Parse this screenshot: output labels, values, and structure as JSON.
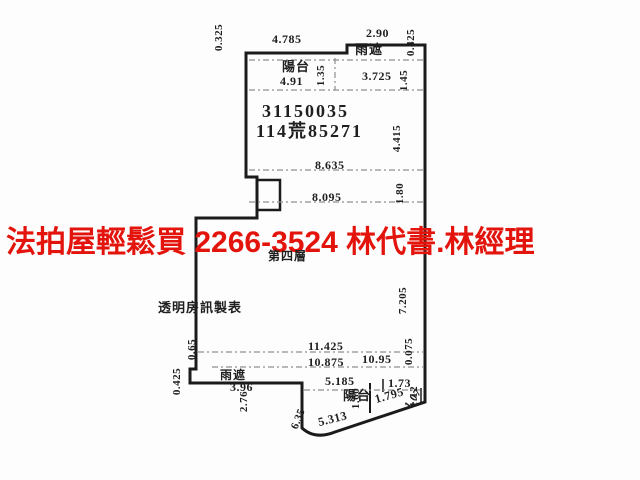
{
  "colors": {
    "wall": "#1b1b1b",
    "dash": "#8f8f8f",
    "text": "#1f1f1f",
    "ad_red": "#e3140c",
    "background": "#fdfdfd"
  },
  "overlay": {
    "ad_text": "法拍屋輕鬆買  2266-3524  林代書.林經理"
  },
  "plan": {
    "parcel_number": "31150035",
    "area_number": "114荒85271",
    "floor_label": "第四層",
    "maker_label": "透明房訊製表",
    "balcony_top_label": "陽台",
    "canopy_top_label": "雨遮",
    "balcony_bottom_label": "陽台",
    "canopy_bottom_label": "雨遮",
    "dims": {
      "top_left_side": "0.325",
      "top_width": "4.785",
      "canopy_top_width": "2.90",
      "top_right_side": "0.425",
      "balcony_top_width": "4.91",
      "balcony_top_depth": "1.35",
      "canopy_top_inner_width": "3.725",
      "canopy_top_depth": "1.45",
      "upper_room_width": "8.635",
      "right_upper_side": "4.415",
      "mid_room_width": "8.095",
      "right_mid_side": "1.80",
      "right_lower_side": "7.205",
      "bottom_total_width": "11.425",
      "bottom_inner_width": "10.875",
      "bottom_inner_width_2": "10.95",
      "right_bottom_small": "0.075",
      "left_lower_small": "0.65",
      "left_bottom_jog": "0.425",
      "canopy_bottom_width": "3.96",
      "left_bottom_side": "2.76",
      "balcony_bottom_width": "5.185",
      "balcony_bottom_depth": "1.60",
      "bottom_right_width": "1.73",
      "right_bottom_side": "1.12",
      "slant_left_seg": "6.35",
      "slant_main_seg": "5.313",
      "slant_right_seg": "1.795",
      "slant_end_seg": "1.07"
    }
  }
}
